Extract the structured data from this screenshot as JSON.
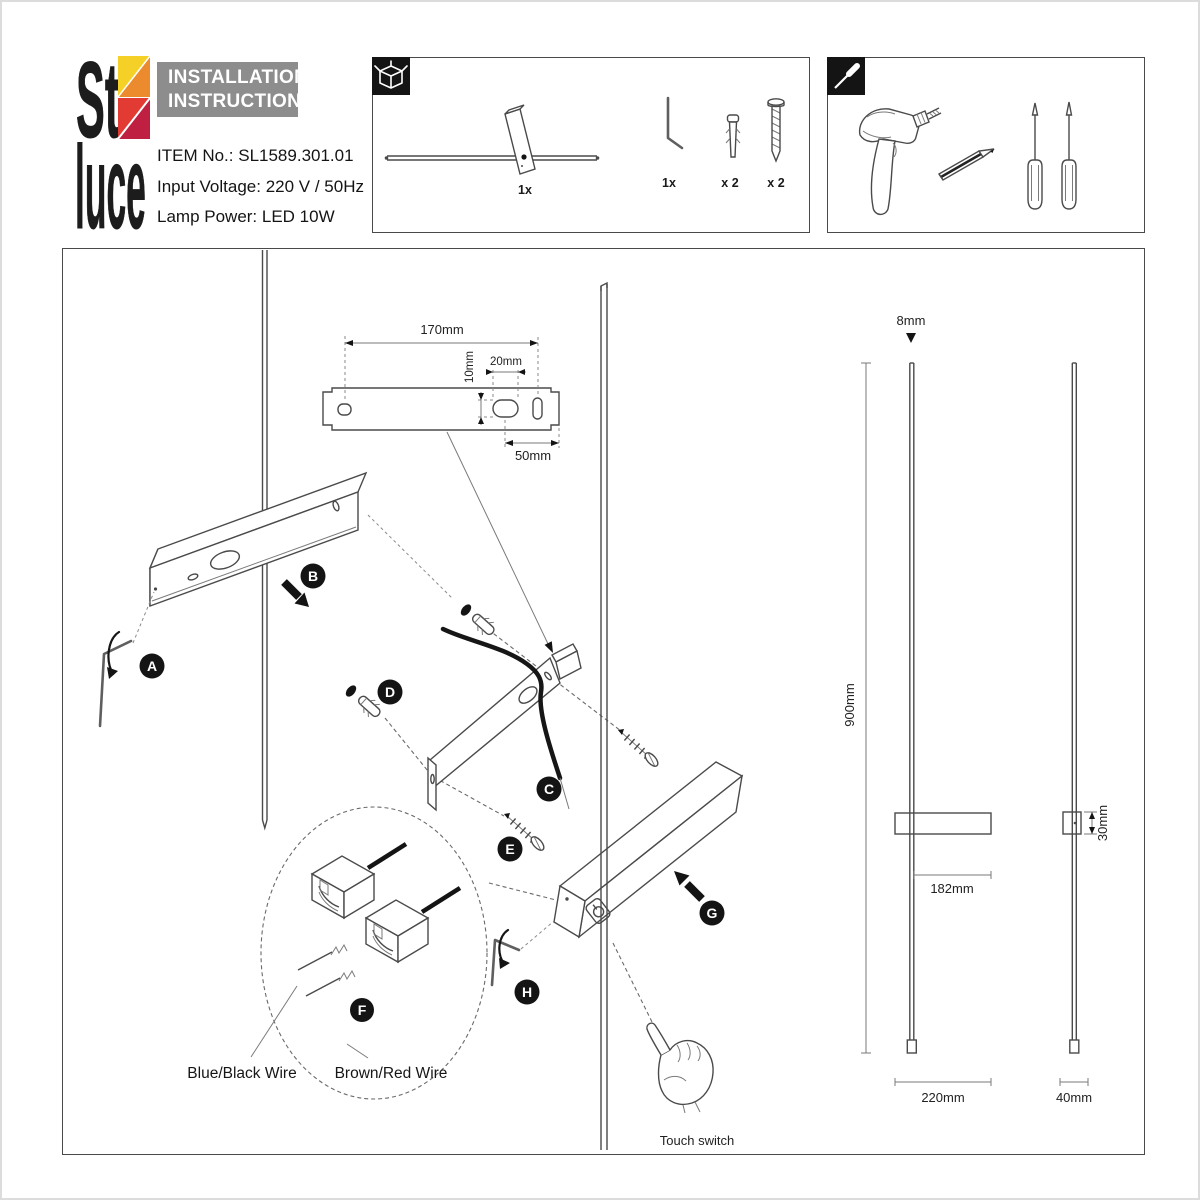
{
  "brand": {
    "logo_top": "St",
    "logo_bottom": "luce"
  },
  "header": {
    "title_line1": "INSTALLATION",
    "title_line2": "INSTRUCTIONS",
    "item_no": "ITEM No.: SL1589.301.01",
    "input_voltage": "Input Voltage: 220 V / 50Hz",
    "lamp_power": "Lamp Power: LED 10W"
  },
  "package_box": {
    "lamp_qty": "1x",
    "allen_key_qty": "1x",
    "wall_plug_qty": "x 2",
    "screw_qty": "x 2",
    "items": [
      "lamp",
      "allen-key",
      "wall-plug",
      "screw"
    ]
  },
  "tools_box": {
    "tools": [
      "drill",
      "pencil",
      "phillips-screwdriver",
      "flat-screwdriver"
    ]
  },
  "diagram": {
    "steps": {
      "a": "A",
      "b": "B",
      "c": "C",
      "d": "D",
      "e": "E",
      "f": "F",
      "g": "G",
      "h": "H"
    },
    "dims": {
      "plate_width": "170mm",
      "hole_height": "10mm",
      "hole_width": "20mm",
      "hole_offset": "50mm",
      "rod_diameter": "8mm",
      "rod_length": "900mm",
      "body_length": "182mm",
      "body_height": "30mm",
      "body_width": "220mm",
      "side_width": "40mm"
    },
    "wire_left": "Blue/Black Wire",
    "wire_right": "Brown/Red Wire",
    "touch_label": "Touch switch"
  },
  "colors": {
    "logo_yellow": "#f5d026",
    "logo_orange": "#ec8b2d",
    "logo_red": "#e23b33",
    "logo_dark_red": "#bf2041",
    "title_bg": "#8d8d8d",
    "line": "#4a4a4a"
  }
}
